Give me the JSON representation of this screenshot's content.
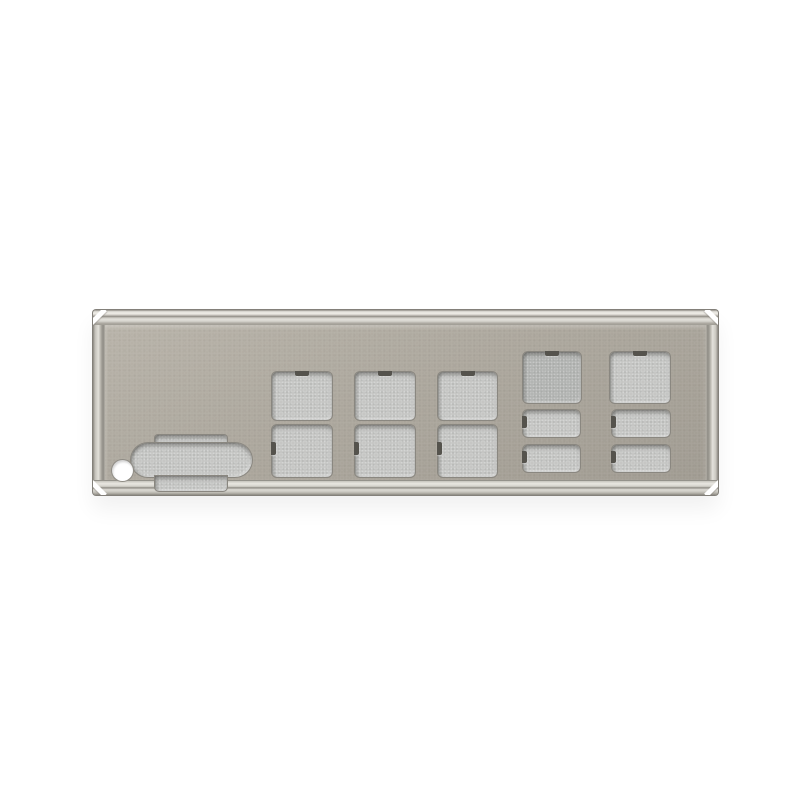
{
  "meta": {
    "description": "Product photo of a metal motherboard rear I/O shield backplate with stamped port cutouts, on a plain white background",
    "object": "rear-io-shield-plate"
  },
  "colors": {
    "background": "#ffffff",
    "face": "#aca79d",
    "face_light": "#b8b3a9",
    "face_dark": "#a09b91",
    "frame_light": "#e9e7e1",
    "frame_mid": "#c7c4bc",
    "frame_dark": "#85827b",
    "cutout_fill": "#c4c5c3",
    "cutout_fill_dark": "#b1b3b1",
    "notch": "#55534d",
    "hole": "#ffffff"
  },
  "plate": {
    "x": 93,
    "y": 310,
    "width": 625,
    "height": 185,
    "frame_h": 15,
    "frame_side": 12
  },
  "cutouts": [
    {
      "name": "dsub-vga-cutout",
      "type": "dsub",
      "x": 38,
      "y": 125,
      "w": 121,
      "h": 56
    },
    {
      "name": "mounting-hole",
      "type": "circle",
      "x": 19,
      "y": 150,
      "w": 21,
      "h": 21
    },
    {
      "name": "port-cutout-top-1",
      "type": "square-top-notch",
      "x": 179,
      "y": 62,
      "w": 60,
      "h": 48
    },
    {
      "name": "port-cutout-top-2",
      "type": "square-top-notch",
      "x": 262,
      "y": 62,
      "w": 60,
      "h": 48
    },
    {
      "name": "port-cutout-top-3",
      "type": "square-top-notch",
      "x": 345,
      "y": 62,
      "w": 59,
      "h": 48
    },
    {
      "name": "port-cutout-bottom-1",
      "type": "square-left-notch",
      "x": 179,
      "y": 115,
      "w": 60,
      "h": 52
    },
    {
      "name": "port-cutout-bottom-2",
      "type": "square-left-notch",
      "x": 262,
      "y": 115,
      "w": 60,
      "h": 52
    },
    {
      "name": "port-cutout-bottom-3",
      "type": "square-left-notch",
      "x": 345,
      "y": 115,
      "w": 59,
      "h": 52
    },
    {
      "name": "lan-port-cutout-1",
      "type": "square-top-notch",
      "x": 430,
      "y": 42,
      "w": 58,
      "h": 51,
      "variant": "dark"
    },
    {
      "name": "lan-port-cutout-2",
      "type": "square-top-notch",
      "x": 517,
      "y": 42,
      "w": 60,
      "h": 51
    },
    {
      "name": "usb-port-cutout-1a",
      "type": "rect-left-notch",
      "x": 430,
      "y": 100,
      "w": 57,
      "h": 27
    },
    {
      "name": "usb-port-cutout-2a",
      "type": "rect-left-notch",
      "x": 430,
      "y": 135,
      "w": 57,
      "h": 27
    },
    {
      "name": "usb-port-cutout-1b",
      "type": "rect-left-notch",
      "x": 519,
      "y": 100,
      "w": 58,
      "h": 27
    },
    {
      "name": "usb-port-cutout-2b",
      "type": "rect-left-notch",
      "x": 519,
      "y": 135,
      "w": 58,
      "h": 27
    }
  ]
}
